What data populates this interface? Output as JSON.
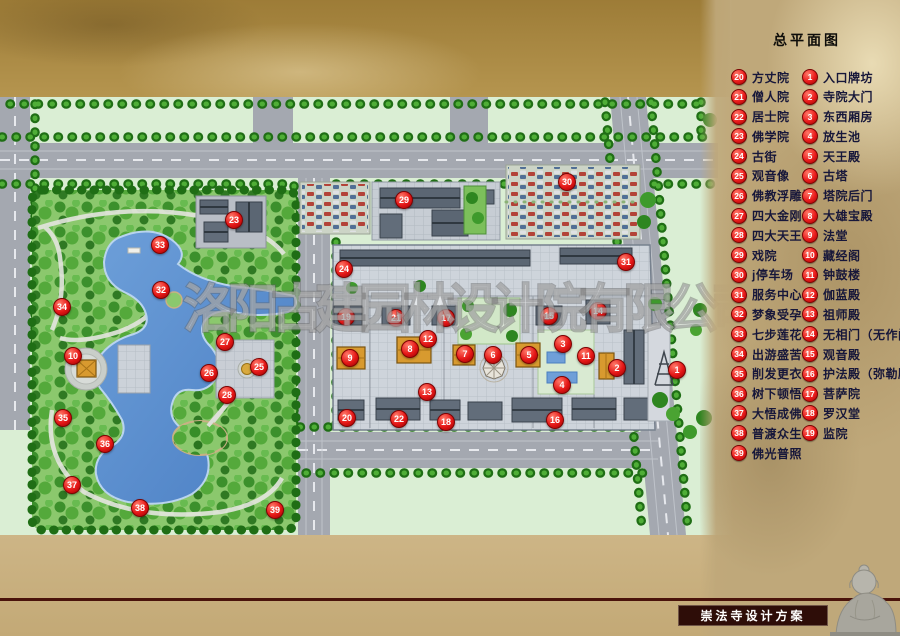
{
  "header": {
    "legend_title": "总平面图"
  },
  "watermark": {
    "text": "洛阳古建园林设计院有限公司"
  },
  "footer": {
    "project_title": "崇法寺设计方案"
  },
  "legend": {
    "right_column": [
      {
        "num": "1",
        "label": "入口牌坊"
      },
      {
        "num": "2",
        "label": "寺院大门"
      },
      {
        "num": "3",
        "label": "东西厢房"
      },
      {
        "num": "4",
        "label": "放生池"
      },
      {
        "num": "5",
        "label": "天王殿"
      },
      {
        "num": "6",
        "label": "古塔"
      },
      {
        "num": "7",
        "label": "塔院后门"
      },
      {
        "num": "8",
        "label": "大雄宝殿"
      },
      {
        "num": "9",
        "label": "法堂"
      },
      {
        "num": "10",
        "label": "藏经阁"
      },
      {
        "num": "11",
        "label": "钟鼓楼"
      },
      {
        "num": "12",
        "label": "伽蓝殿"
      },
      {
        "num": "13",
        "label": "祖师殿"
      },
      {
        "num": "14",
        "label": "无相门（无作门"
      },
      {
        "num": "15",
        "label": "观音殿"
      },
      {
        "num": "16",
        "label": "护法殿（弥勒殿"
      },
      {
        "num": "17",
        "label": "菩萨院"
      },
      {
        "num": "18",
        "label": "罗汉堂"
      },
      {
        "num": "19",
        "label": "监院"
      }
    ],
    "left_column": [
      {
        "num": "20",
        "label": "方丈院"
      },
      {
        "num": "21",
        "label": "僧人院"
      },
      {
        "num": "22",
        "label": "居士院"
      },
      {
        "num": "23",
        "label": "佛学院"
      },
      {
        "num": "24",
        "label": "古街"
      },
      {
        "num": "25",
        "label": "观音像"
      },
      {
        "num": "26",
        "label": "佛教浮雕墙"
      },
      {
        "num": "27",
        "label": "四大金刚"
      },
      {
        "num": "28",
        "label": "四大天王"
      },
      {
        "num": "29",
        "label": "戏院"
      },
      {
        "num": "30",
        "label": "j停车场"
      },
      {
        "num": "31",
        "label": "服务中心"
      },
      {
        "num": "32",
        "label": "梦象受孕"
      },
      {
        "num": "33",
        "label": "七步莲花"
      },
      {
        "num": "34",
        "label": "出游盛苦"
      },
      {
        "num": "35",
        "label": "削发更衣"
      },
      {
        "num": "36",
        "label": "树下顿悟"
      },
      {
        "num": "37",
        "label": "大悟成佛"
      },
      {
        "num": "38",
        "label": "普渡众生"
      },
      {
        "num": "39",
        "label": "佛光普照"
      }
    ]
  },
  "markers": [
    {
      "num": "1",
      "x": 676,
      "y": 369
    },
    {
      "num": "2",
      "x": 616,
      "y": 367
    },
    {
      "num": "3",
      "x": 562,
      "y": 343
    },
    {
      "num": "4",
      "x": 561,
      "y": 384
    },
    {
      "num": "5",
      "x": 528,
      "y": 354
    },
    {
      "num": "6",
      "x": 492,
      "y": 354
    },
    {
      "num": "7",
      "x": 464,
      "y": 353
    },
    {
      "num": "8",
      "x": 409,
      "y": 348
    },
    {
      "num": "9",
      "x": 349,
      "y": 357
    },
    {
      "num": "10",
      "x": 72,
      "y": 355
    },
    {
      "num": "11",
      "x": 585,
      "y": 355
    },
    {
      "num": "12",
      "x": 427,
      "y": 338
    },
    {
      "num": "13",
      "x": 426,
      "y": 391
    },
    {
      "num": "14",
      "x": 597,
      "y": 310
    },
    {
      "num": "15",
      "x": 548,
      "y": 315
    },
    {
      "num": "16",
      "x": 554,
      "y": 419
    },
    {
      "num": "17",
      "x": 445,
      "y": 317
    },
    {
      "num": "18",
      "x": 445,
      "y": 421
    },
    {
      "num": "19",
      "x": 345,
      "y": 316
    },
    {
      "num": "20",
      "x": 346,
      "y": 417
    },
    {
      "num": "21",
      "x": 395,
      "y": 317
    },
    {
      "num": "22",
      "x": 398,
      "y": 418
    },
    {
      "num": "23",
      "x": 233,
      "y": 219
    },
    {
      "num": "24",
      "x": 343,
      "y": 268
    },
    {
      "num": "25",
      "x": 258,
      "y": 366
    },
    {
      "num": "26",
      "x": 208,
      "y": 372
    },
    {
      "num": "27",
      "x": 224,
      "y": 341
    },
    {
      "num": "28",
      "x": 226,
      "y": 394
    },
    {
      "num": "29",
      "x": 403,
      "y": 199
    },
    {
      "num": "30",
      "x": 566,
      "y": 181
    },
    {
      "num": "31",
      "x": 625,
      "y": 261
    },
    {
      "num": "32",
      "x": 160,
      "y": 289
    },
    {
      "num": "33",
      "x": 159,
      "y": 244
    },
    {
      "num": "34",
      "x": 61,
      "y": 306
    },
    {
      "num": "35",
      "x": 62,
      "y": 417
    },
    {
      "num": "36",
      "x": 104,
      "y": 443
    },
    {
      "num": "37",
      "x": 71,
      "y": 484
    },
    {
      "num": "38",
      "x": 139,
      "y": 507
    },
    {
      "num": "39",
      "x": 274,
      "y": 509
    }
  ],
  "legend_layout": {
    "left_col_x": 731,
    "right_col_x": 802,
    "start_y": 77,
    "step_y": 19.79
  },
  "colors": {
    "marker_red": "#e51717",
    "legend_text": "#17173a",
    "panel_tan": "#bfa87a",
    "band_gold": "#a9893f",
    "map_green": "#daeed4",
    "park_green": "#8bc86d",
    "lake_blue": "#5d92d1",
    "road_gray": "#a4a8b0",
    "maroon_line": "#4a130b",
    "titlebox_bg": "#2e0d08"
  }
}
